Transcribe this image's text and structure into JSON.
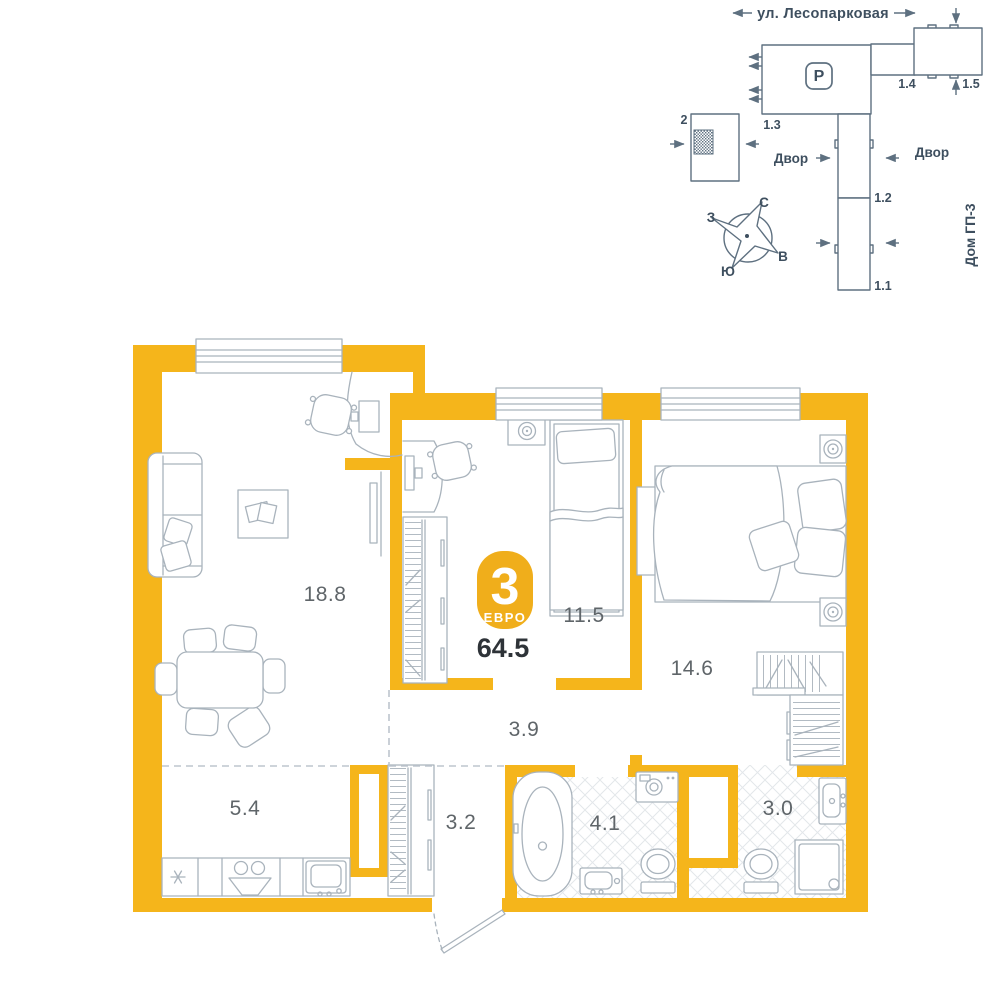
{
  "apartment": {
    "rooms_count": "3",
    "type_label": "ЕВРО",
    "total_area": "64.5",
    "areas": {
      "living": "18.8",
      "bedroom_small": "11.5",
      "bedroom_master": "14.6",
      "hallway": "3.9",
      "kitchen": "5.4",
      "closet": "3.2",
      "bathroom": "4.1",
      "wc": "3.0"
    }
  },
  "site_map": {
    "street": "ул. Лесопарковая",
    "yard_left": "Двор",
    "yard_right": "Двор",
    "house_label": "Дом ГП-3",
    "parking_label": "P",
    "sections": {
      "s1_1": "1.1",
      "s1_2": "1.2",
      "s1_3": "1.3",
      "s1_4": "1.4",
      "s1_5": "1.5",
      "s2": "2"
    },
    "compass": {
      "north": "С",
      "south": "Ю",
      "west": "З",
      "east": "В"
    }
  },
  "colors": {
    "wall": "#F5B51B",
    "badge": "#F0AE1B",
    "furniture_line": "#A9B3BC",
    "map_line": "#5E7080",
    "map_text": "#3E4F5F",
    "room_label": "#5F6569",
    "dark_text": "#2E3338",
    "tile_line": "#E3E7EA",
    "zone_dash": "#BDC5CD"
  }
}
